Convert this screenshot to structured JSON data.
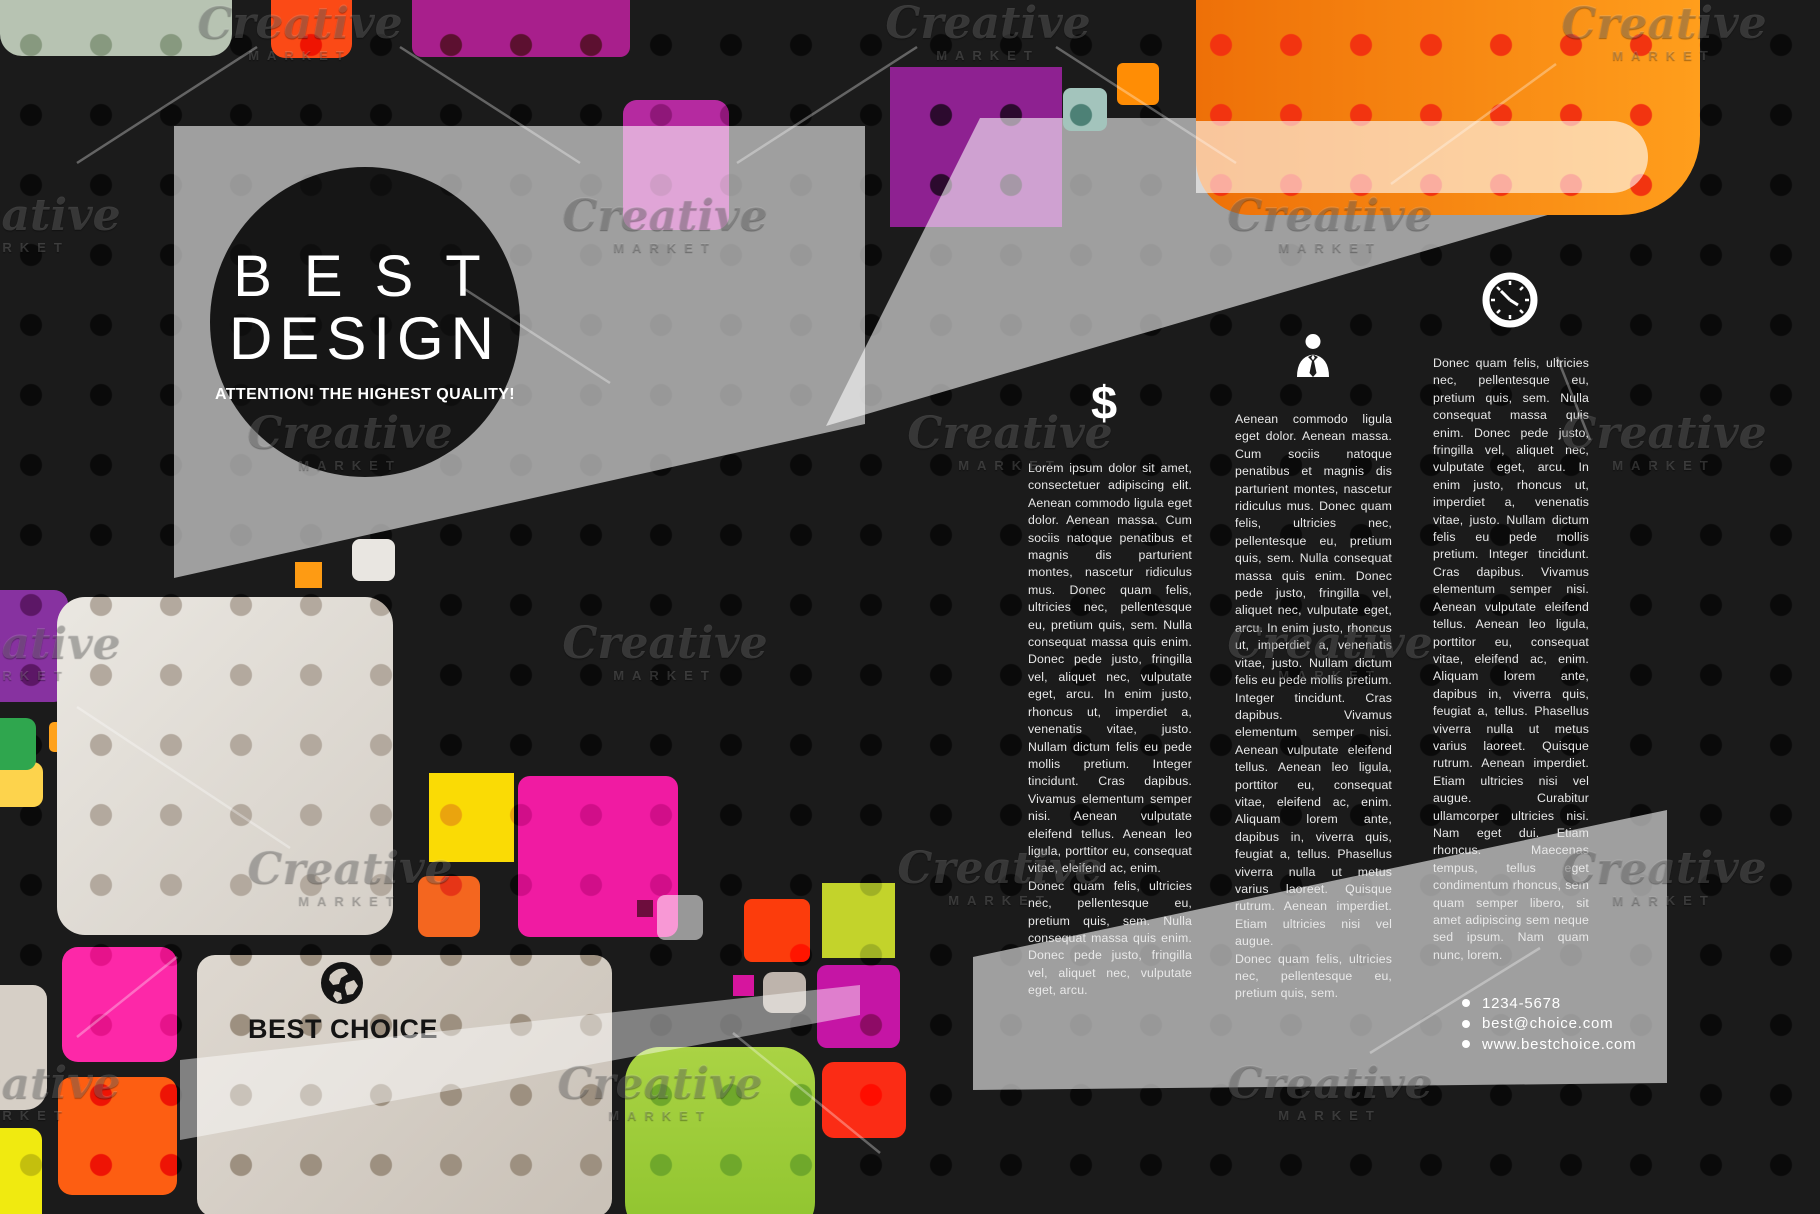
{
  "logo": {
    "title_line1": "BEST",
    "title_line2": "DESIGN",
    "tagline": "ATTENTION! THE HIGHEST QUALITY!"
  },
  "columns": [
    {
      "icon": "dollar-icon",
      "icon_glyph": "$",
      "paragraphs": [
        "Lorem ipsum dolor sit amet, consectetuer adipiscing elit. Aenean commodo ligula eget dolor. Aenean massa. Cum sociis natoque penatibus et magnis dis parturient montes, nascetur ridiculus mus. Donec quam felis, ultricies nec, pellentesque eu, pretium quis, sem. Nulla consequat massa quis enim. Donec pede justo, fringilla vel, aliquet nec, vulputate eget, arcu. In enim justo, rhoncus ut, imperdiet a, venenatis vitae, justo. Nullam dictum felis eu pede mollis pretium. Integer tincidunt. Cras dapibus. Vivamus elementum semper nisi. Aenean vulputate eleifend tellus. Aenean leo ligula, porttitor eu, consequat vitae, eleifend ac, enim.",
        "Donec quam felis, ultricies nec, pellentesque eu, pretium quis, sem. Nulla consequat massa quis enim. Donec pede justo, fringilla vel, aliquet nec, vulputate eget, arcu."
      ]
    },
    {
      "icon": "person-icon",
      "paragraphs": [
        "Aenean commodo ligula eget dolor. Aenean massa. Cum sociis natoque penatibus et magnis dis parturient montes, nascetur ridiculus mus. Donec quam felis, ultricies nec, pellentesque eu, pretium quis, sem. Nulla consequat massa quis enim. Donec pede justo, fringilla vel, aliquet nec, vulputate eget, arcu. In enim justo, rhoncus ut, imperdiet a, venenatis vitae, justo. Nullam dictum felis eu pede mollis pretium. Integer tincidunt. Cras dapibus. Vivamus elementum semper nisi. Aenean vulputate eleifend tellus. Aenean leo ligula, porttitor eu, consequat vitae, eleifend ac, enim. Aliquam lorem ante, dapibus in, viverra quis, feugiat a, tellus. Phasellus viverra nulla ut metus varius laoreet. Quisque rutrum. Aenean imperdiet. Etiam ultricies nisi vel augue.",
        "Donec quam felis, ultricies nec, pellentesque eu, pretium quis, sem."
      ]
    },
    {
      "icon": "clock-icon",
      "paragraphs": [
        "Donec quam felis, ultricies nec, pellentesque eu, pretium quis, sem. Nulla consequat massa quis enim. Donec pede justo, fringilla vel, aliquet nec, vulputate eget, arcu. In enim justo, rhoncus ut, imperdiet a, venenatis vitae, justo. Nullam dictum felis eu pede mollis pretium. Integer tincidunt. Cras dapibus. Vivamus elementum semper nisi. Aenean vulputate eleifend tellus. Aenean leo ligula, porttitor eu, consequat vitae, eleifend ac, enim. Aliquam lorem ante, dapibus in, viverra quis, feugiat a, tellus. Phasellus viverra nulla ut metus varius laoreet. Quisque rutrum. Aenean imperdiet. Etiam ultricies nisi vel augue. Curabitur ullamcorper ultricies nisi. Nam eget dui. Etiam rhoncus. Maecenas tempus, tellus eget condimentum rhoncus, sem quam semper libero, sit amet adipiscing sem neque sed ipsum. Nam quam nunc, lorem."
      ]
    }
  ],
  "choice": {
    "label": "BEST CHOICE",
    "icon": "globe-icon"
  },
  "contact": {
    "items": [
      "1234-5678",
      "best@choice.com",
      "www.bestchoice.com"
    ]
  },
  "watermark": {
    "script": "Creative",
    "caption": "MARKET"
  }
}
